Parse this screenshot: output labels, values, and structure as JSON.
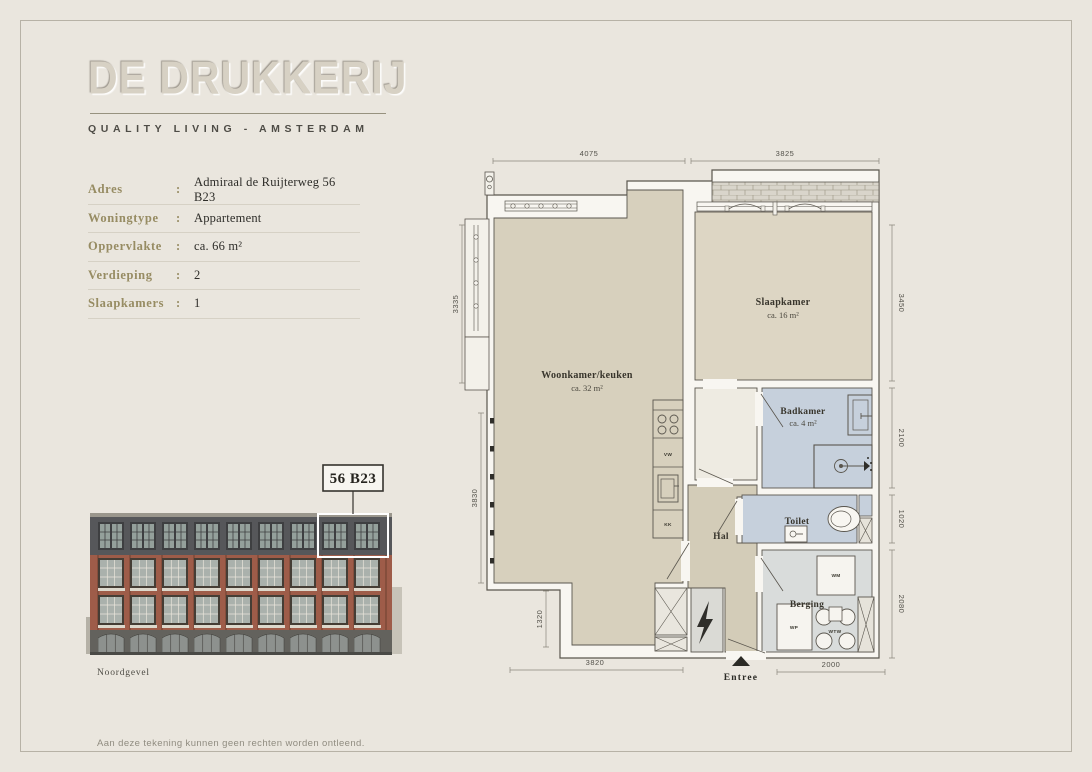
{
  "brand": {
    "name": "DE DRUKKERIJ",
    "tagline": "QUALITY LIVING - AMSTERDAM"
  },
  "details": {
    "separator": ":",
    "rows": [
      {
        "label": "Adres",
        "value": "Admiraal de Ruijterweg 56 B23"
      },
      {
        "label": "Woningtype",
        "value": "Appartement"
      },
      {
        "label": "Oppervlakte",
        "value": "ca. 66 m²"
      },
      {
        "label": "Verdieping",
        "value": "2"
      },
      {
        "label": "Slaapkamers",
        "value": "1"
      }
    ]
  },
  "elevation": {
    "unit_label": "56 B23",
    "caption": "Noordgevel"
  },
  "floorplan": {
    "rooms": {
      "woonkamer": {
        "name": "Woonkamer/keuken",
        "area": "ca. 32 m²"
      },
      "slaapkamer": {
        "name": "Slaapkamer",
        "area": "ca. 16 m²"
      },
      "badkamer": {
        "name": "Badkamer",
        "area": "ca. 4 m²"
      },
      "toilet": {
        "name": "Toilet"
      },
      "hal": {
        "name": "Hal"
      },
      "berging": {
        "name": "Berging"
      }
    },
    "appliances": {
      "vw": "VW",
      "kk": "KK",
      "wm": "WM",
      "wp": "WP",
      "wtw": "WTW"
    },
    "entrance_label": "Entree",
    "dimensions": {
      "top": [
        "4075",
        "3825"
      ],
      "left": [
        "3335",
        "3830",
        "1320"
      ],
      "right": [
        "3450",
        "2100",
        "1020",
        "2080"
      ],
      "bottom": [
        "3820",
        "2000"
      ]
    }
  },
  "footer": {
    "disclaimer": "Aan deze tekening kunnen geen rechten worden ontleend."
  },
  "colors": {
    "background": "#eae6de",
    "detail_label": "#978c63",
    "floor_tan": "#d7d0bd",
    "wet_room_blue": "#c6d0dc",
    "storage_grey": "#d9dcdb",
    "brick_red": "#9e5c49"
  }
}
